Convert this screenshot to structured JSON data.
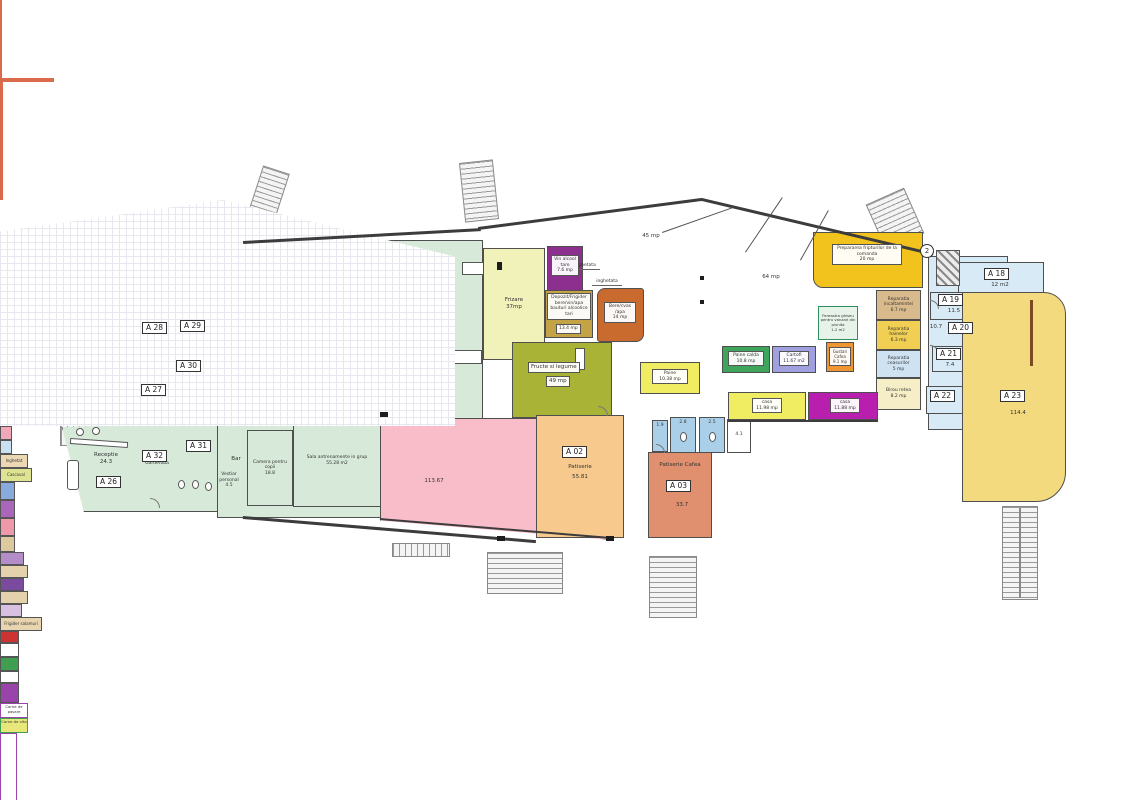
{
  "zones": {
    "lactate_line1": "Zona",
    "lactate_line2": "lactate/salamuri/muraturi",
    "peste": "Zona Peste",
    "carne": "Zona Carne"
  },
  "areas": {
    "market_45": "45 mp",
    "market_64": "64 mp",
    "hall": "62.5",
    "fitness_pink": "113.67"
  },
  "symbols": {
    "axis_2": "2"
  },
  "fixtures": {
    "inghetata_note": "inghetata",
    "inghetat_box": "Inghetat",
    "cascaval": "Cascaval",
    "frigider_salamuri": "Frigider salamuri",
    "carne_pasare": "Carne de pasare",
    "carne_vita": "Carne de vita"
  },
  "rooms": {
    "a26": {
      "code": "A 26",
      "name": "Receptie",
      "area": "24.3"
    },
    "a27": {
      "code": "A 27",
      "area": "13.1"
    },
    "a28": {
      "code": "A 28",
      "area": "9.6"
    },
    "a29": {
      "code": "A 29",
      "name": "panouri electrice pentru tot parterul",
      "area": "16.4"
    },
    "a30": {
      "code": "A 30",
      "name": "Departament incasari",
      "area": "13.2"
    },
    "a31": {
      "code": "A 31"
    },
    "a32": {
      "code": "A 32",
      "name": "Garderoba"
    },
    "a02": {
      "code": "A 02",
      "name": "Patiserie",
      "area": "55.81"
    },
    "a03": {
      "code": "A 03",
      "name": "Patiserie Cafea",
      "area": "33.7"
    },
    "a18": {
      "code": "A 18",
      "area": "12 m2"
    },
    "a19": {
      "code": "A 19",
      "area": "11.5"
    },
    "a20": {
      "code": "A 20",
      "area": "10.7"
    },
    "a21": {
      "code": "A 21",
      "area": "7.4"
    },
    "a22": {
      "code": "A 22"
    },
    "a23": {
      "code": "A 23",
      "area": "114.4"
    },
    "bar": {
      "name": "Bar"
    },
    "vestiar_personal": {
      "name": "Vestiar personal",
      "area": "4.5"
    },
    "vestiar_femei": {
      "name": "Vestiar femei",
      "area": "19"
    },
    "vestiar_barbati": {
      "name": "Vestiar barbati",
      "area": "17.8"
    },
    "dus_1": {
      "name": "Dus",
      "area": "12.4"
    },
    "dus_2": {
      "name": "Dus",
      "area": "10.25"
    },
    "boiler": {
      "name": "Boiler"
    },
    "gts_1": {
      "name": "GTS",
      "area": "0.75"
    },
    "gts_2": {
      "name": "GTS",
      "area": "3.35"
    },
    "retele": {
      "name": "Retele",
      "area": "7.8"
    },
    "solar": {
      "name": "solar",
      "area": "2.6"
    },
    "masaj": {
      "name": "Masaj",
      "area": "9.3"
    },
    "camera_copii": {
      "name": "Camera pentru copii",
      "area": "18.8"
    },
    "sala_grup": {
      "name": "Sala antrenamente in grup",
      "area": "55.28 m2"
    },
    "sala": {
      "name": "Sala antrenamente",
      "area": "150 mp"
    },
    "frizare": {
      "name": "Frizare",
      "area": "37mp"
    },
    "vin": {
      "name": "Vin alcool tare",
      "area": "7.6 mp"
    },
    "depozit": {
      "name": "Depozit/Frigider bere/vin/apa bauturi alcoolice tari",
      "area": "13.4 mp"
    },
    "bere": {
      "name": "Bere/cvas /apa",
      "area": "14 mp"
    },
    "fructe": {
      "name": "Fructe si legume",
      "area": "49 mp"
    },
    "preparare": {
      "name": "Prepararea fripturilor de la comanda",
      "area": "20 mp"
    },
    "rep_incaltaminte": {
      "name": "Reparatia incaltamintei",
      "area": "6.7 mp"
    },
    "rep_haine": {
      "name": "Reparatia hainelor",
      "area": "6.3 mp"
    },
    "rep_ceasuri": {
      "name": "Reparatia ceasurilor",
      "area": "5 mp"
    },
    "birou": {
      "name": "Birou retea",
      "area": "8.2 mp"
    },
    "fereastra": {
      "name": "Fereastra ghiseu pentru vanzari din pivnita",
      "area": "1-2 m2"
    },
    "gustari": {
      "name": "Gustari Cafea",
      "area": "9.1 mp"
    },
    "paine_1": {
      "name": "Paine",
      "area": "10.38 mp"
    },
    "paine_2": {
      "name": "Paine calda",
      "area": "10.8 mp"
    },
    "cartofi": {
      "name": "Cartofi",
      "area": "11.67 m2"
    },
    "casa_1": {
      "name": "casa",
      "area": "11.98 mp"
    },
    "casa_2": {
      "name": "casa",
      "area": "11.88 mp"
    },
    "wc_1": {
      "area": "1.9"
    },
    "wc_2": {
      "area": "2.8"
    },
    "wc_3": {
      "area": "2.5"
    },
    "wc_hol": {
      "area": "4.1"
    }
  },
  "colors": {
    "wall": "#3c3c3c",
    "green": "#d7e9d8",
    "orange": "#f7c98d",
    "pink": "#f9bdc9",
    "cream": "#f1f1ba",
    "purple": "#8d2f8f",
    "khaki": "#c3a345",
    "rust": "#c96a2e",
    "olive": "#a9b335",
    "gold": "#f2c31d",
    "magenta": "#b81fae",
    "lightblue": "#d8eaf6",
    "a23_yellow": "#f3da7e"
  }
}
